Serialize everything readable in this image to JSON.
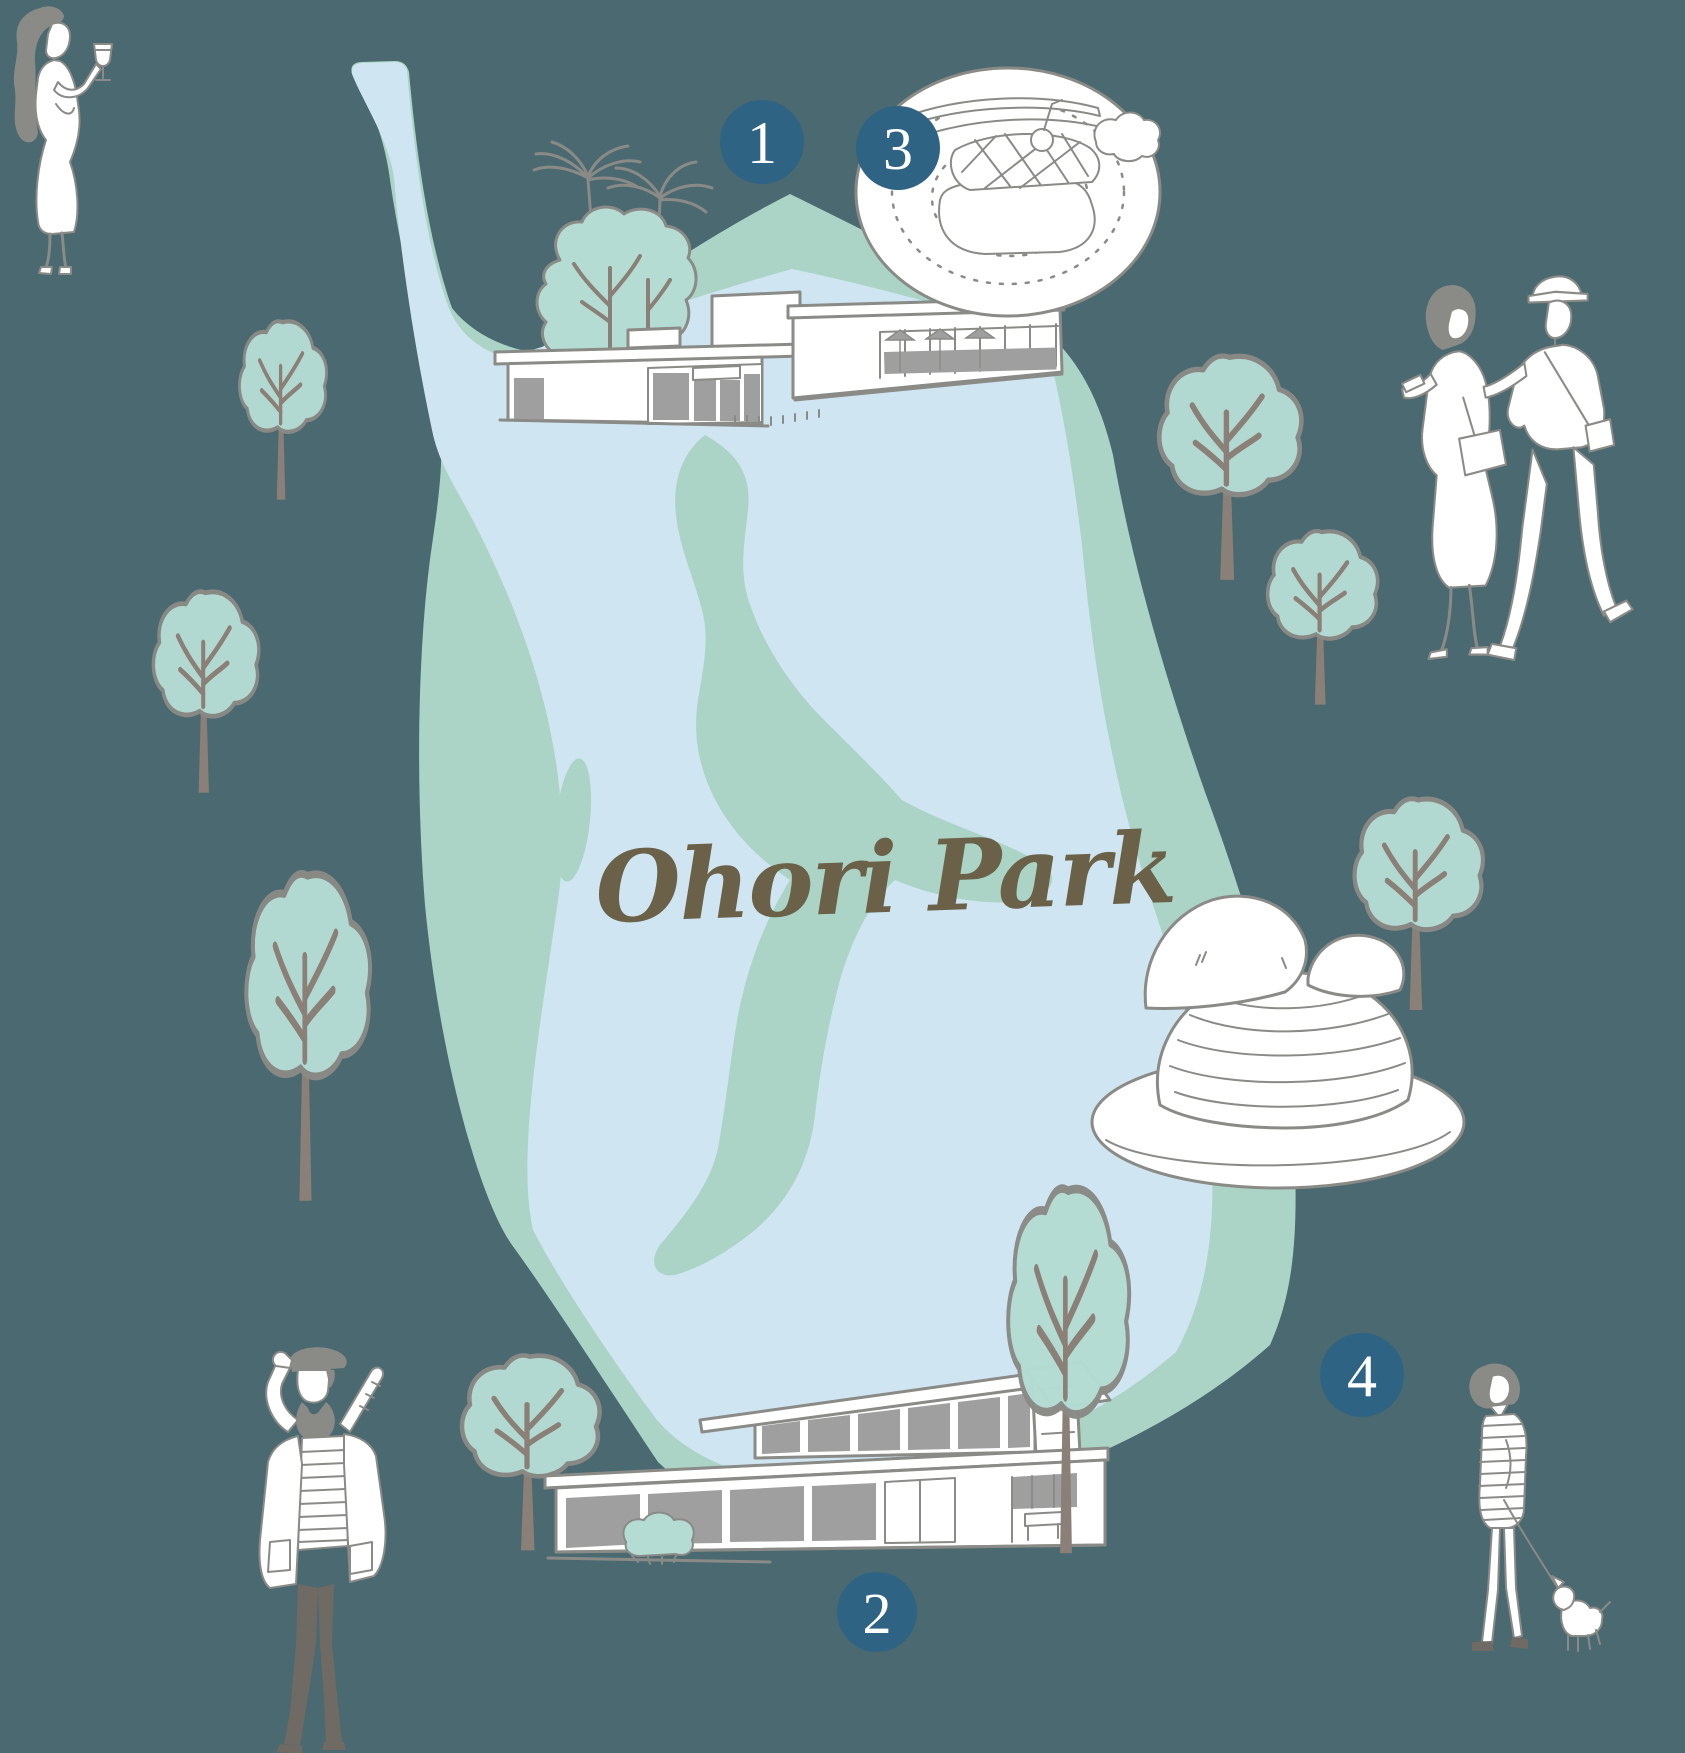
{
  "map": {
    "title": "Ohori Park",
    "markers": [
      {
        "number": "1"
      },
      {
        "number": "2"
      },
      {
        "number": "3"
      },
      {
        "number": "4"
      }
    ]
  },
  "illustrations": {
    "lake": "park lake",
    "stream": "stream and islands in the lake",
    "pavilion": "modern park pavilion building",
    "boathouse": "lakeside boathouse building",
    "palm_trees": "palm trees",
    "trees": "round park trees",
    "dish_plate": "plated grilled dish with knife",
    "mont_blanc": "mont blanc dessert on a plate",
    "woman_wine": "woman holding a wine glass",
    "couple": "strolling couple",
    "man_baguette": "man in beret with baguette",
    "woman_dog": "woman walking a small dog"
  },
  "colors": {
    "background": "#4a6970",
    "lake_blue": "#cfe6f2",
    "shore_green": "#abd4c6",
    "tree_green": "#b4dcd3",
    "marker_blue": "#2f6384",
    "title_brown": "#6b6149",
    "line_gray": "#8a8a86",
    "window_gray": "#9f9f9f",
    "trunk_brown": "#8a8077",
    "pants_gray": "#6f6a63"
  }
}
